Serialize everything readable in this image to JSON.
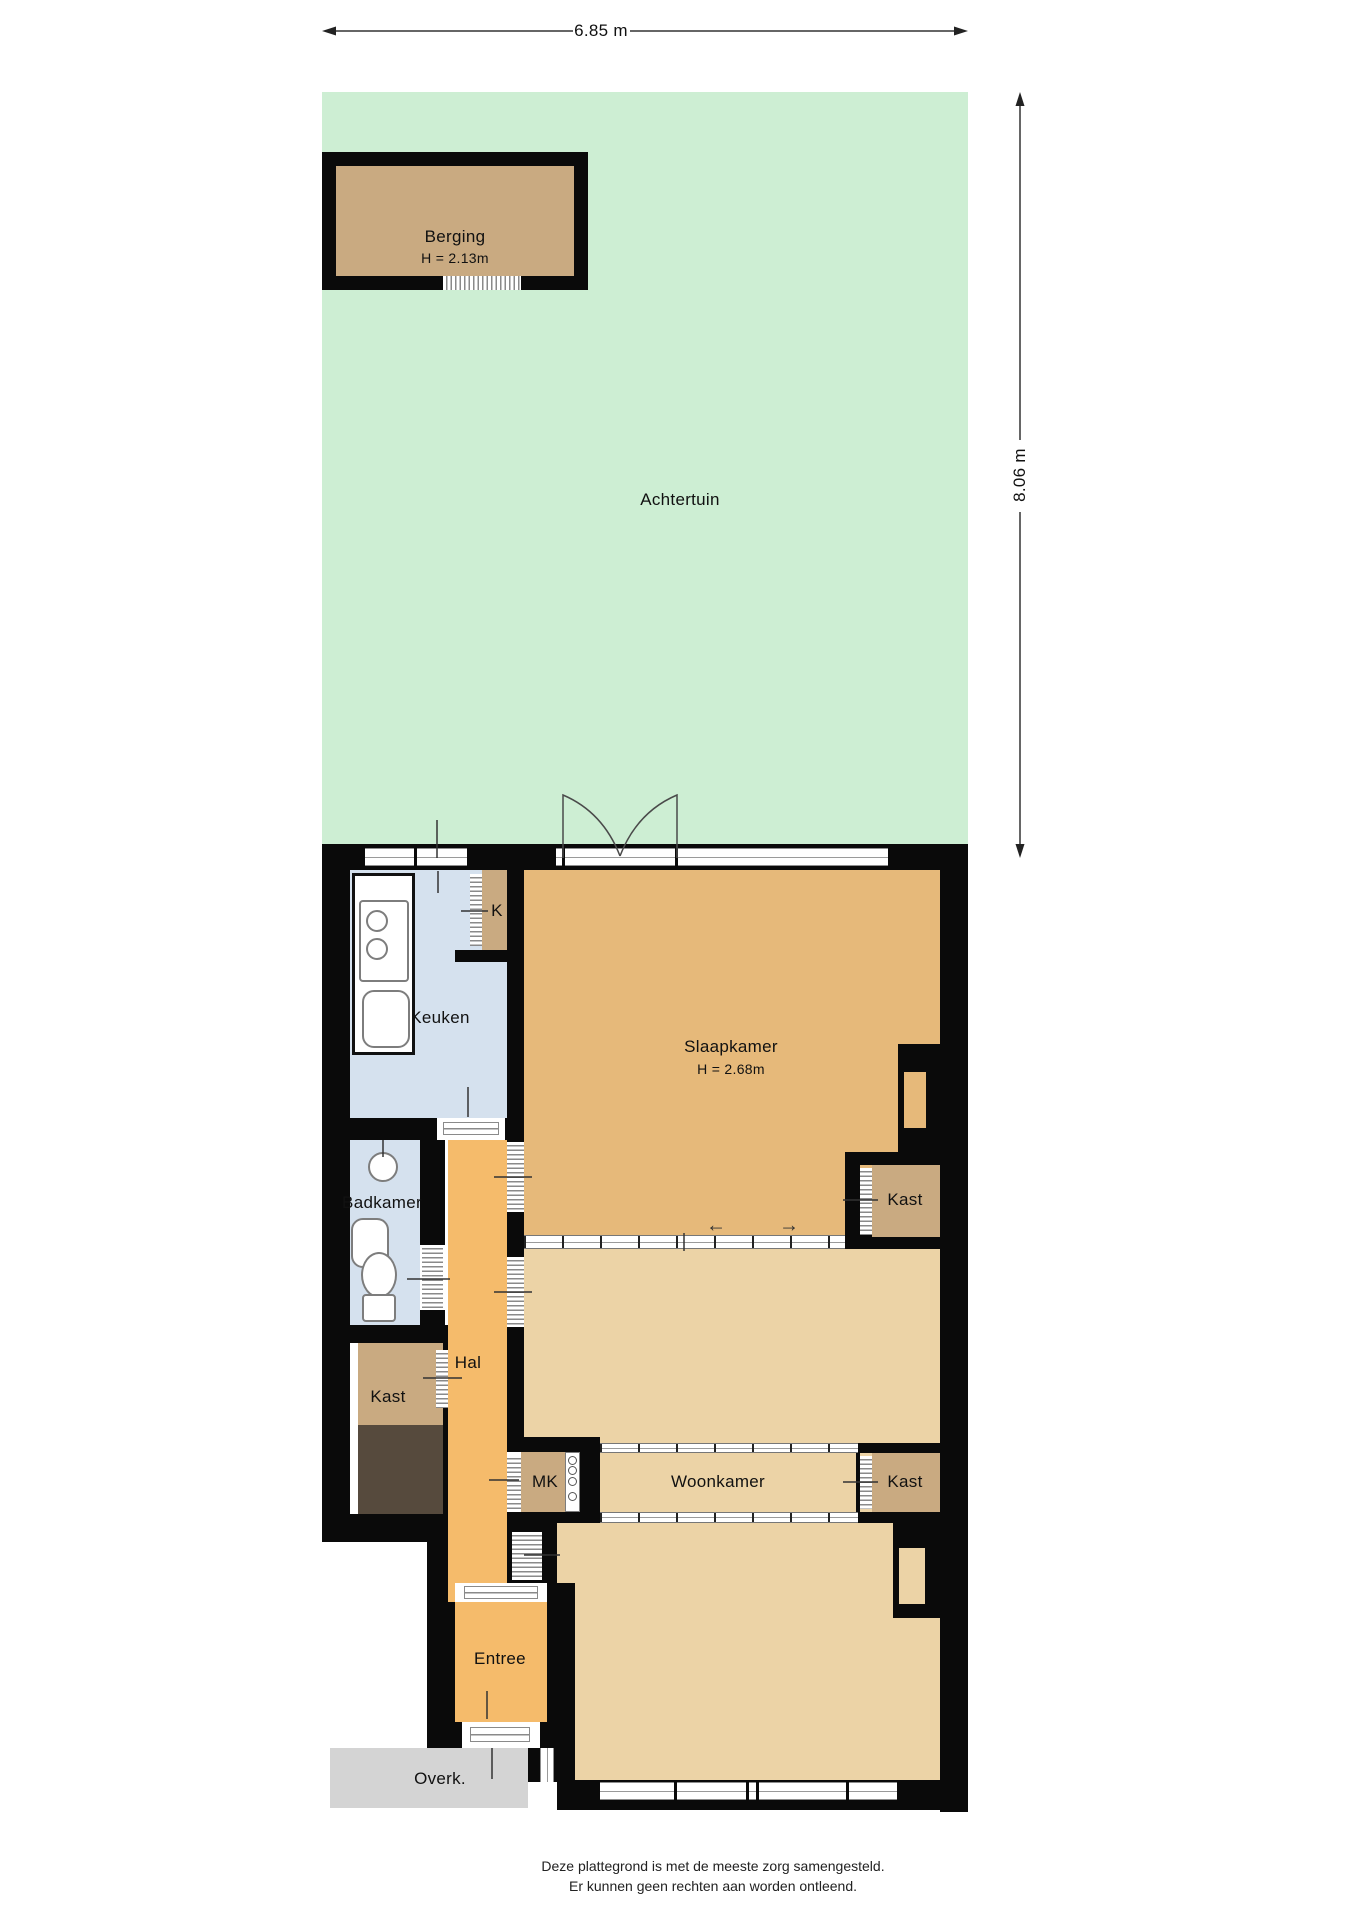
{
  "plan": {
    "title": "floor-plan",
    "dims": {
      "width_label": "6.85 m",
      "height_label": "8.06 m"
    },
    "rooms": {
      "achtertuin": "Achtertuin",
      "berging": "Berging",
      "berging_height": "H = 2.13m",
      "keuken": "Keuken",
      "k_closet": "K",
      "slaapkamer": "Slaapkamer",
      "slaapkamer_height": "H = 2.68m",
      "badkamer": "Badkamer",
      "hal": "Hal",
      "kast_left": "Kast",
      "kast_top_right": "Kast",
      "kast_bottom_right": "Kast",
      "mk": "MK",
      "woonkamer": "Woonkamer",
      "entree": "Entree",
      "overkapping": "Overk."
    },
    "arrows": {
      "left": "←",
      "right": "→"
    },
    "footer": {
      "line1": "Deze plattegrond is met de meeste zorg samengesteld.",
      "line2": "Er kunnen geen rechten aan worden ontleend."
    },
    "colors": {
      "garden": "#cdeed3",
      "storage_tan": "#c9aa81",
      "bedroom": "#e6b97a",
      "hall_orange": "#f5bb6b",
      "living_tan": "#ecd3a6",
      "kitchen_bath_blue": "#d5e1ee",
      "dark_room": "#564a3d",
      "canopy_gray": "#d4d4d4",
      "wall": "#0a0a0a"
    }
  }
}
